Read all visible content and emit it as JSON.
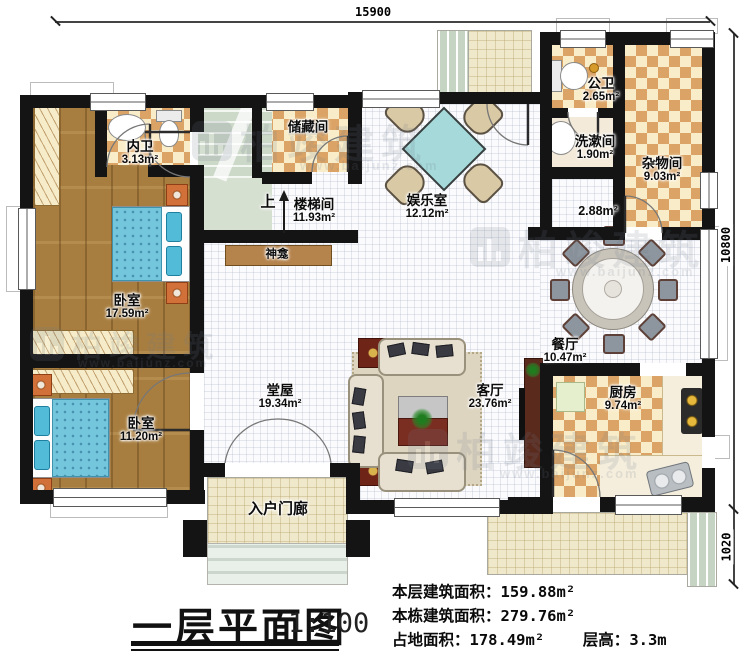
{
  "dimensions": {
    "top": "15900",
    "right": "10800",
    "right_lower": "1020"
  },
  "rooms": {
    "neiwei": {
      "name": "内卫",
      "area": "3.13m²"
    },
    "woshi_a": {
      "name": "卧室",
      "area": "17.59m²"
    },
    "woshi_b": {
      "name": "卧室",
      "area": "11.20m²"
    },
    "chucangjian": {
      "name": "储藏间"
    },
    "loutijian": {
      "name": "楼梯间",
      "area": "11.93m²"
    },
    "shang": {
      "name": "上"
    },
    "shenkan": {
      "name": "神龛"
    },
    "yuleshi": {
      "name": "娱乐室",
      "area": "12.12m²"
    },
    "gongwei": {
      "name": "公卫",
      "area": "2.65m²"
    },
    "xishujian": {
      "name": "洗漱间",
      "area": "1.90m²"
    },
    "zawujian": {
      "name": "杂物间",
      "area": "9.03m²"
    },
    "hall_area": {
      "area": "2.88m²"
    },
    "canting": {
      "name": "餐厅",
      "area": "10.47m²"
    },
    "chufang": {
      "name": "厨房",
      "area": "9.74m²"
    },
    "keting": {
      "name": "客厅",
      "area": "23.76m²"
    },
    "tangwu": {
      "name": "堂屋",
      "area": "19.34m²"
    },
    "ruhu": {
      "name": "入户门廊"
    }
  },
  "titleblock": {
    "title": "一层平面图",
    "scale": "1:100"
  },
  "stats": {
    "line1_label": "本层建筑面积：",
    "line1_value": "159.88m²",
    "line2_label": "本栋建筑面积：",
    "line2_value": "279.76m²",
    "line3_label": "占地面积：",
    "line3_value": "178.49m²",
    "line4_label": "层高：",
    "line4_value": "3.3m"
  },
  "watermark": {
    "brand": "柏竣建筑",
    "url": "www.baijunz.com"
  },
  "colors": {
    "wall": "#141414",
    "wood": "#a87e40",
    "tile": "#d69854",
    "bed": "#74c6dd",
    "stairs": "#ccd8c8"
  }
}
